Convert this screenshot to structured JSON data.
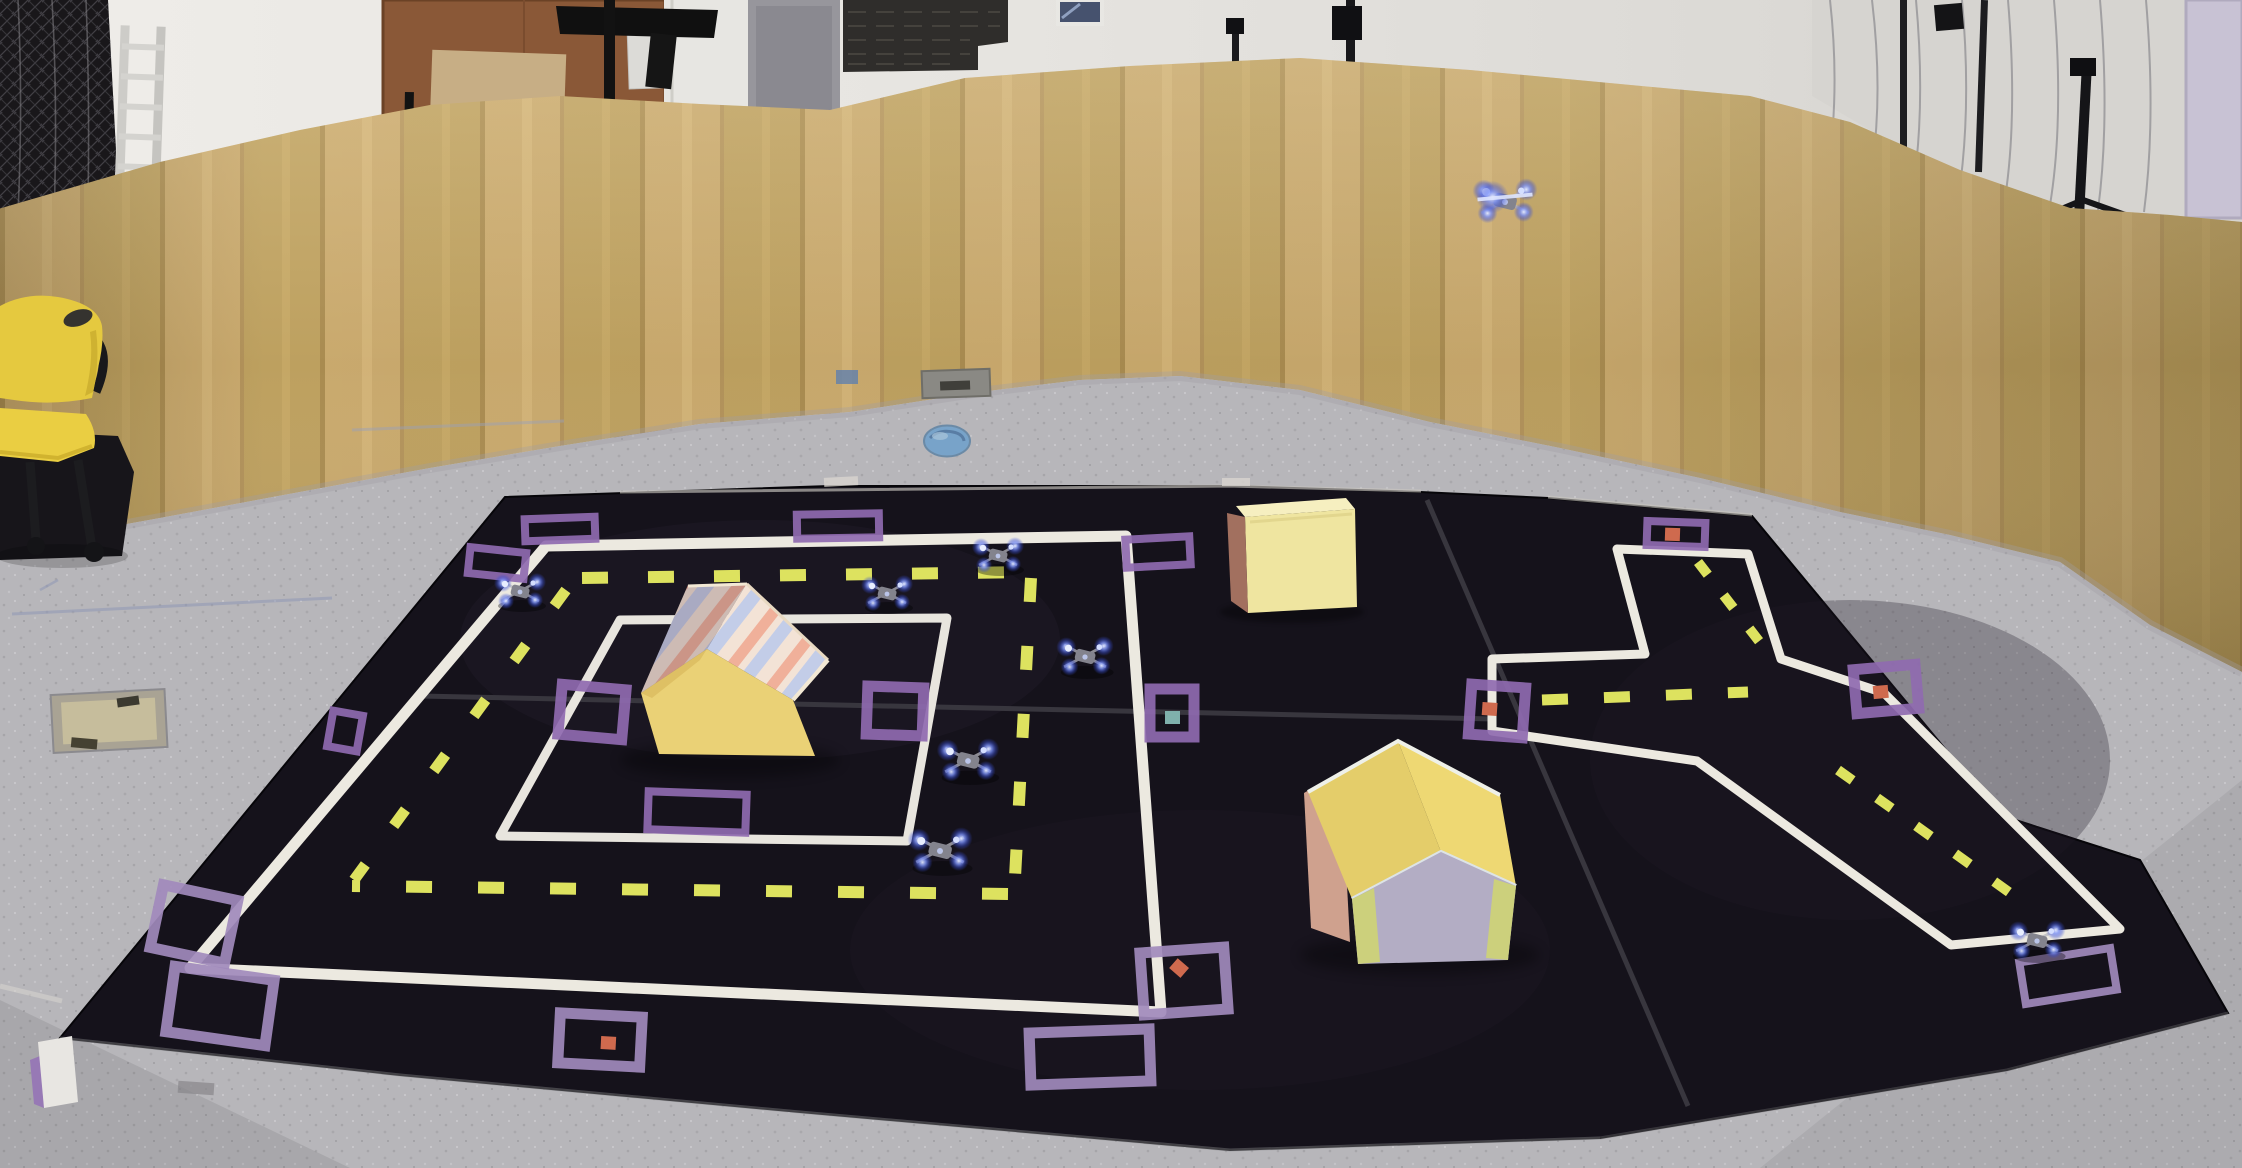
{
  "scene": {
    "kind": "photograph",
    "subject": "indoor drone-testing arena with miniature taped city mat, cardboard houses and quadcopter drones",
    "inventory": {
      "drone_count": 8,
      "flying_drone_count": 1,
      "house_count": 2,
      "obstacle_box_count": 1,
      "waypoint_marker_count": 18,
      "chair_count": 1
    }
  },
  "palette": {
    "cardboard": "#c9a96d",
    "cardboard_dark": "#bda05f",
    "wall_white": "#e6e4e0",
    "floor_gray": "#b7b6ba",
    "mat_black": "#15121b",
    "road_tape_white": "#ece9e0",
    "lane_dash_yellow": "#dde25f",
    "waypoint_purple": "#8f6ab0",
    "waypoint_purple_light": "#a18abc",
    "dot_red": "#cf6a4e",
    "dot_teal": "#7fb0ac",
    "drone_led_blue": "#5a74f0",
    "house_yellow": "#ead176",
    "roof_stripe_pink": "#f0b09a",
    "roof_stripe_blue": "#c3cde8",
    "roof_stripe_cream": "#f3e3d6",
    "house2_roof_yellow": "#ecd873",
    "house2_front_lavender": "#b3adc4",
    "house2_trim_green": "#ccd07c",
    "box_yellow": "#efe5a0",
    "box_side_brown": "#a2705f",
    "chair_yellow": "#e5c93f",
    "door_orange": "#8a5837"
  },
  "drones": [
    {
      "id": "drone-flying",
      "x": 1505,
      "y": 202,
      "s": 1.25,
      "flying": true
    },
    {
      "id": "drone-1",
      "x": 998,
      "y": 556,
      "s": 1.0,
      "flying": false
    },
    {
      "id": "drone-2",
      "x": 887,
      "y": 594,
      "s": 1.0,
      "flying": false
    },
    {
      "id": "drone-3",
      "x": 520,
      "y": 592,
      "s": 1.0,
      "flying": false
    },
    {
      "id": "drone-4",
      "x": 1085,
      "y": 657,
      "s": 1.1,
      "flying": false
    },
    {
      "id": "drone-5",
      "x": 968,
      "y": 761,
      "s": 1.2,
      "flying": false
    },
    {
      "id": "drone-6",
      "x": 940,
      "y": 851,
      "s": 1.25,
      "flying": false
    },
    {
      "id": "drone-7",
      "x": 2037,
      "y": 941,
      "s": 1.1,
      "flying": false
    }
  ],
  "waypoint_markers": [
    {
      "x": 560,
      "y": 529,
      "w": 70,
      "h": 22,
      "rot": -2
    },
    {
      "x": 838,
      "y": 526,
      "w": 82,
      "h": 24,
      "rot": -1
    },
    {
      "x": 1158,
      "y": 552,
      "w": 64,
      "h": 28,
      "rot": -3
    },
    {
      "x": 497,
      "y": 563,
      "w": 56,
      "h": 26,
      "rot": 6
    },
    {
      "x": 592,
      "y": 712,
      "w": 64,
      "h": 50,
      "rot": 5
    },
    {
      "x": 895,
      "y": 711,
      "w": 56,
      "h": 48,
      "rot": 2
    },
    {
      "x": 697,
      "y": 812,
      "w": 98,
      "h": 38,
      "rot": 2
    },
    {
      "x": 1172,
      "y": 713,
      "w": 44,
      "h": 48,
      "rot": 0,
      "dot": "teal",
      "dx": 0,
      "dy": 4
    },
    {
      "x": 345,
      "y": 731,
      "w": 30,
      "h": 36,
      "rot": 10
    },
    {
      "x": 194,
      "y": 924,
      "w": 76,
      "h": 64,
      "rot": 12,
      "light": true
    },
    {
      "x": 220,
      "y": 1006,
      "w": 100,
      "h": 66,
      "rot": 8,
      "light": true
    },
    {
      "x": 600,
      "y": 1040,
      "w": 82,
      "h": 50,
      "rot": 3,
      "dot": "red",
      "dx": 8,
      "dy": 2,
      "light": true
    },
    {
      "x": 1090,
      "y": 1057,
      "w": 120,
      "h": 52,
      "rot": -2,
      "light": true
    },
    {
      "x": 1184,
      "y": 981,
      "w": 84,
      "h": 62,
      "rot": -4,
      "dot": "red-diamond",
      "dx": -4,
      "dy": -14,
      "light": true
    },
    {
      "x": 1676,
      "y": 534,
      "w": 58,
      "h": 24,
      "rot": 2,
      "dot": "red",
      "dx": -4,
      "dy": 0
    },
    {
      "x": 1886,
      "y": 689,
      "w": 62,
      "h": 44,
      "rot": -5,
      "dot": "red",
      "dx": -6,
      "dy": 2
    },
    {
      "x": 1497,
      "y": 711,
      "w": 54,
      "h": 50,
      "rot": 4,
      "dot": "red",
      "dx": -8,
      "dy": -2
    },
    {
      "x": 2068,
      "y": 976,
      "w": 92,
      "h": 42,
      "rot": -9,
      "light": true
    }
  ]
}
